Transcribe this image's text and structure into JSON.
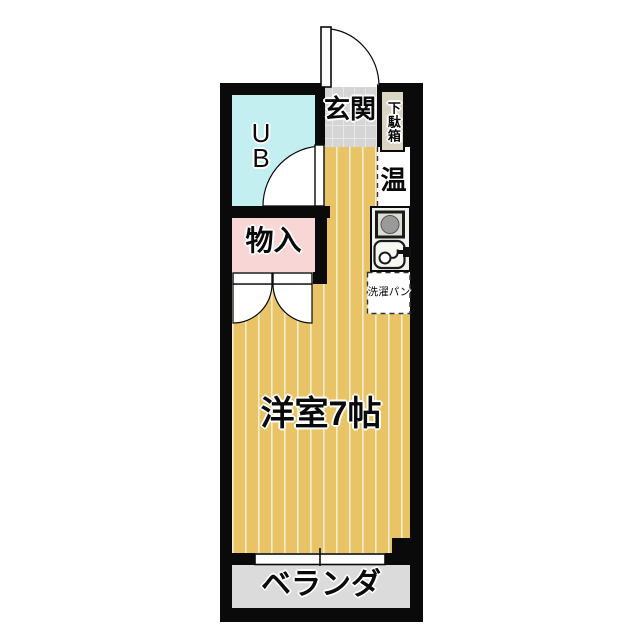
{
  "floorplan": {
    "type": "apartment-floor-plan",
    "rooms": {
      "entrance": {
        "label": "玄関"
      },
      "shoe_cabinet": {
        "label": "下駄箱"
      },
      "unit_bath": {
        "label": "UB",
        "label_lines": [
          "U",
          "B"
        ]
      },
      "storage": {
        "label": "物入"
      },
      "water_heater": {
        "label": "温"
      },
      "laundry_pan": {
        "label": "洗濯パン"
      },
      "main_room": {
        "label": "洋室7帖"
      },
      "balcony": {
        "label": "ベランダ"
      }
    },
    "icons": {
      "kitchen_unit": "single-burner-kitchenette-icon",
      "entrance_door": "door-swing-arc",
      "unit_bath_door": "door-swing-arc",
      "storage_doors": "double-door-swing-arcs",
      "window": "sliding-window-symbol"
    },
    "colors": {
      "wall": "#0a0a0a",
      "unit_bath_floor": "#c3eff1",
      "storage_floor": "#f8d6d6",
      "entrance_floor": "#d5d5d5",
      "entrance_tile_line": "#e7e7e7",
      "shoe_cabinet_bg": "#dad4c3",
      "wood_floor": "#e9c467",
      "wood_stripe": "#f6ecce",
      "balcony_floor": "#dbdbdb",
      "utility_floor": "#ffffff",
      "door_leaf": "#ffffff"
    }
  }
}
